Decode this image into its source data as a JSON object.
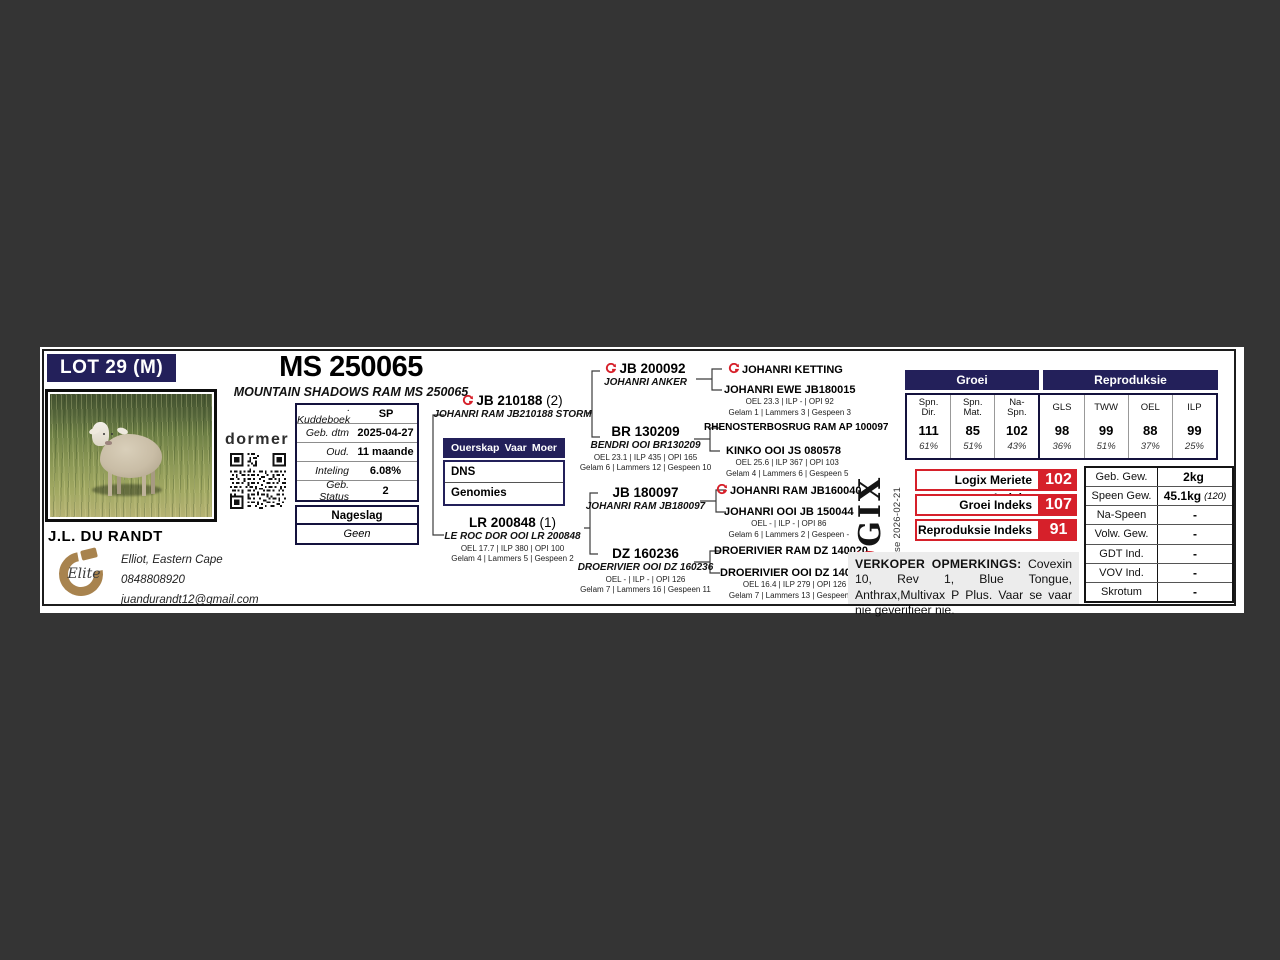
{
  "window": {
    "background": "#343434",
    "card_background": "#ffffff"
  },
  "colors": {
    "navy": "#23205a",
    "red": "#d6202a"
  },
  "header": {
    "lot_label": "LOT 29 (M)",
    "title": "MS 250065",
    "subtitle": "MOUNTAIN SHADOWS RAM MS 250065"
  },
  "breeder": {
    "brand": "dormer",
    "name": "J.L. DU RANDT",
    "elite_label": "Elite",
    "location": "Elliot, Eastern Cape",
    "phone": "0848808920",
    "email": "juandurandt12@gmail.com"
  },
  "details": {
    "rows": [
      {
        "label": ". Kuddeboek",
        "value": "SP"
      },
      {
        "label": "Geb. dtm",
        "value": "2025-04-27"
      },
      {
        "label": "Oud.",
        "value": "11 maande"
      },
      {
        "label": "Inteling",
        "value": "6.08%"
      },
      {
        "label": "Geb. Status",
        "value": "2"
      }
    ]
  },
  "nageslag": {
    "title": "Nageslag",
    "value": "Geen"
  },
  "ouerskap": {
    "title": "Ouerskap",
    "col_vaar": "Vaar",
    "col_moer": "Moer",
    "rows": [
      "DNS",
      "Genomies"
    ]
  },
  "pedigree": {
    "sire": {
      "id": "JB 210188",
      "suffix": "(2)",
      "name": "JOHANRI RAM JB210188 STORM"
    },
    "dam": {
      "id": "LR 200848",
      "suffix": "(1)",
      "name": "LE ROC DOR OOI LR 200848",
      "stats": "OEL 17.7 | ILP 380 | OPI 100",
      "progeny": "Gelam 4 | Lammers 5 | Gespeen 2"
    },
    "gen2": [
      {
        "id": "JB 200092",
        "name": "JOHANRI ANKER"
      },
      {
        "id": "BR 130209",
        "name": "BENDRI OOI BR130209",
        "stats": "OEL 23.1 | ILP 435 | OPI 165",
        "progeny": "Gelam 6 | Lammers 12 | Gespeen 10"
      },
      {
        "id": "JB 180097",
        "name": "JOHANRI RAM JB180097"
      },
      {
        "id": "DZ 160236",
        "name": "DROERIVIER OOI DZ 160236",
        "stats": "OEL - | ILP - | OPI 126",
        "progeny": "Gelam 7 | Lammers 16 | Gespeen 11"
      }
    ],
    "gen3": [
      {
        "name": "JOHANRI KETTING"
      },
      {
        "name": "JOHANRI EWE JB180015",
        "stats": "OEL 23.3 | ILP - | OPI 92",
        "progeny": "Gelam 1 | Lammers 3 | Gespeen 3"
      },
      {
        "name": "RHENOSTERBOSRUG RAM AP 100097"
      },
      {
        "name": "KINKO OOI JS 080578",
        "stats": "OEL 25.6 | ILP 367 | OPI 103",
        "progeny": "Gelam 4 | Lammers 6 | Gespeen 5"
      },
      {
        "name": "JOHANRI RAM JB160040"
      },
      {
        "name": "JOHANRI OOI JB 150044",
        "stats": "OEL - | ILP - | OPI 86",
        "progeny": "Gelam 6 | Lammers 2 | Gespeen -"
      },
      {
        "name": "DROERIVIER RAM DZ 140020"
      },
      {
        "name": "DROERIVIER OOI DZ 140159",
        "stats": "OEL 16.4 | ILP 279 | OPI 126",
        "progeny": "Gelam 7 | Lammers 13 | Gespeen 13"
      }
    ]
  },
  "ebv": {
    "group1": "Groei",
    "group2": "Reproduksie",
    "columns": [
      {
        "l1": "Spn.",
        "l2": "Dir.",
        "v": "111",
        "a": "61%"
      },
      {
        "l1": "Spn.",
        "l2": "Mat.",
        "v": "85",
        "a": "51%"
      },
      {
        "l1": "Na-",
        "l2": "Spn.",
        "v": "102",
        "a": "43%"
      },
      {
        "l1": "GLS",
        "l2": "",
        "v": "98",
        "a": "36%"
      },
      {
        "l1": "TWW",
        "l2": "",
        "v": "99",
        "a": "51%"
      },
      {
        "l1": "OEL",
        "l2": "",
        "v": "88",
        "a": "37%"
      },
      {
        "l1": "ILP",
        "l2": "",
        "v": "99",
        "a": "25%"
      }
    ]
  },
  "logix": {
    "logo_l": "L",
    "logo_o": "Ø",
    "logo_rest": "GIX",
    "analysis": "EBV Analise 2026-02-21"
  },
  "indexes": [
    {
      "label": "Logix Meriete Indeks",
      "value": "102"
    },
    {
      "label": "Groei Indeks",
      "value": "107"
    },
    {
      "label": "Reproduksie Indeks",
      "value": "91"
    }
  ],
  "weights": {
    "rows": [
      {
        "label": "Geb. Gew.",
        "value": "2kg",
        "note": ""
      },
      {
        "label": "Speen Gew.",
        "value": "45.1kg",
        "note": "(120)"
      },
      {
        "label": "Na-Speen",
        "value": "-",
        "note": ""
      },
      {
        "label": "Volw. Gew.",
        "value": "-",
        "note": ""
      },
      {
        "label": "GDT Ind.",
        "value": "-",
        "note": ""
      },
      {
        "label": "VOV Ind.",
        "value": "-",
        "note": ""
      },
      {
        "label": "Skrotum",
        "value": "-",
        "note": ""
      }
    ]
  },
  "remarks": {
    "heading": "VERKOPER OPMERKINGS:",
    "text": "Covexin 10, Rev 1, Blue Tongue, Anthrax,Multivax P Plus. Vaar se vaar nie geverifieer nie."
  }
}
